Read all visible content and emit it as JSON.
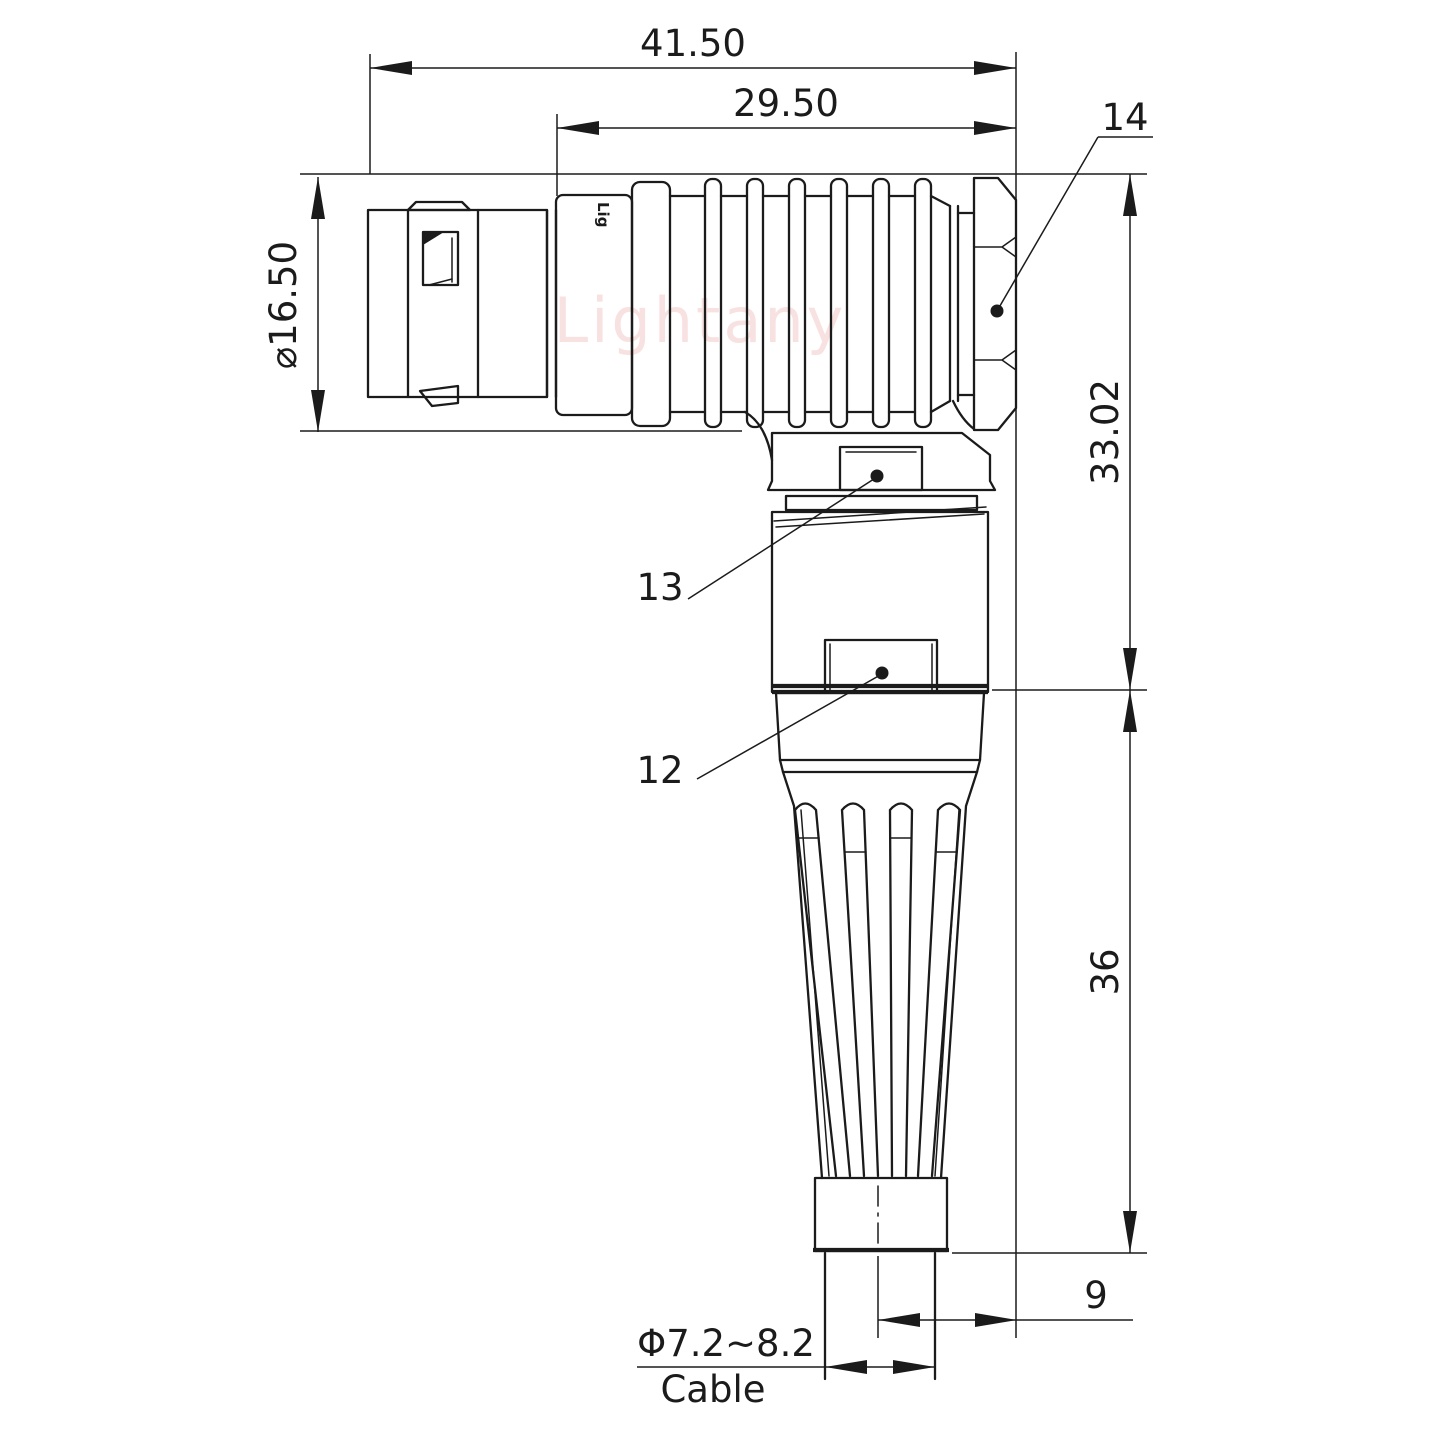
{
  "drawing": {
    "watermark_text": "Lightany",
    "engraving_text": "Lig",
    "dimensions": {
      "total_length": "41.50",
      "rear_length": "29.50",
      "front_diameter": "⌀16.50",
      "upper_height": "33.02",
      "lower_height": "36",
      "cable_offset": "9",
      "cable_diameter": "Φ7.2~8.2",
      "cable_label": "Cable"
    },
    "part_labels": {
      "coupling_nut": "14",
      "clamp_nut": "13",
      "body_shell": "12"
    },
    "colors": {
      "line": "#1b1b1b",
      "watermark": "#f2c4c4",
      "background": "#ffffff"
    }
  }
}
